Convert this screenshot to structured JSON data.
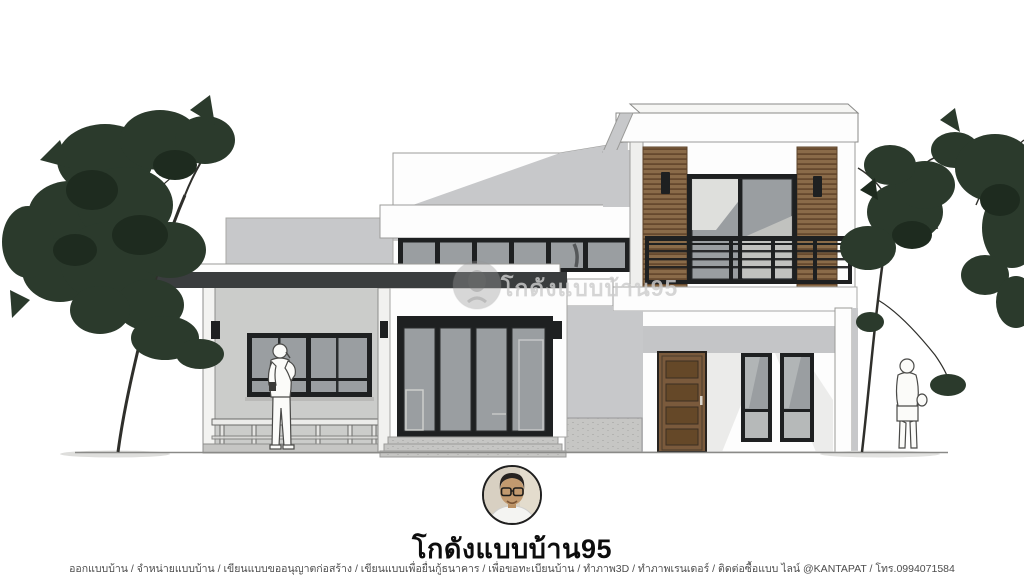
{
  "brand": {
    "title": "โกดังแบบบ้าน95",
    "watermark_text": "โกดังแบบบ้าน95"
  },
  "footer": {
    "services_line": "ออกแบบบ้าน / จำหน่ายแบบบ้าน / เขียนแบบขออนุญาตก่อสร้าง / เขียนแบบเพื่อยื่นกู้ธนาคาร / เพื่อขอทะเบียนบ้าน / ทำภาพ3D / ทำภาพเรนเดอร์ / ติดต่อซื้อแบบ ไลน์ @KANTAPAT / โทร.0994071584"
  },
  "colors": {
    "wall_white": "#fdfdfd",
    "wall_shadow": "#c7c8ca",
    "roof_dark": "#3a3d3e",
    "frame_black": "#1e2021",
    "glass": "#9a9ea1",
    "glass_light": "#b6b9b9",
    "wood": "#8a6b49",
    "wood_dark": "#66492e",
    "door_wood": "#7a5a3c",
    "door_wood_dark": "#654828",
    "foliage": "#2b3a2c",
    "foliage_dark": "#1e2b1f",
    "trunk": "#2f2f2b",
    "concrete": "#c6c6c4",
    "title_color": "#0d0d0d",
    "footer_color": "#4c4c4c",
    "watermark_color": "#cdcdcd"
  }
}
